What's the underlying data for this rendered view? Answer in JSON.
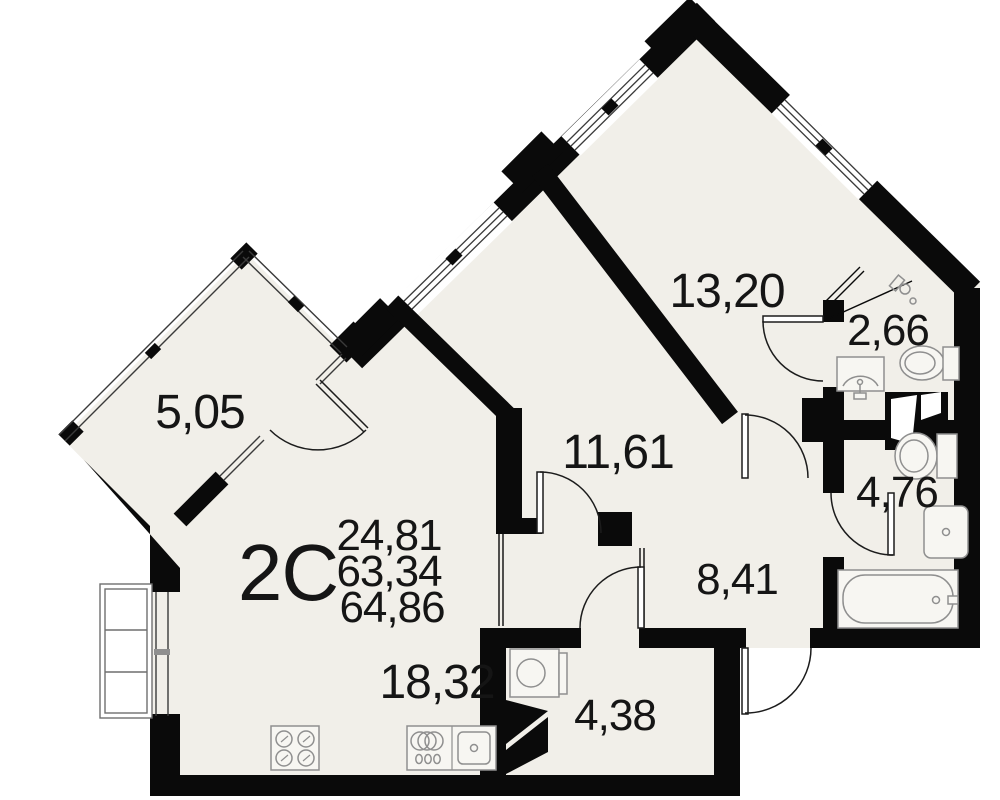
{
  "plan": {
    "title": "apartment-floor-plan",
    "apartment": {
      "type_label": "2С",
      "living_area": "24,81",
      "area": "63,34",
      "total_area": "64,86"
    },
    "rooms": [
      {
        "id": "balcony",
        "area_label": "5,05"
      },
      {
        "id": "bedroom",
        "area_label": "13,20"
      },
      {
        "id": "wc-small",
        "area_label": "2,66"
      },
      {
        "id": "room-middle",
        "area_label": "11,61"
      },
      {
        "id": "bathroom",
        "area_label": "4,76"
      },
      {
        "id": "hallway",
        "area_label": "8,41"
      },
      {
        "id": "storage",
        "area_label": "4,38"
      },
      {
        "id": "kitchen-living",
        "area_label": "18,32"
      }
    ],
    "colors": {
      "floor": "#f1efe9",
      "wall": "#0a0a0a",
      "fixture_stroke": "#8f8f8f",
      "text": "#151515",
      "outside": "#ffffff"
    }
  }
}
